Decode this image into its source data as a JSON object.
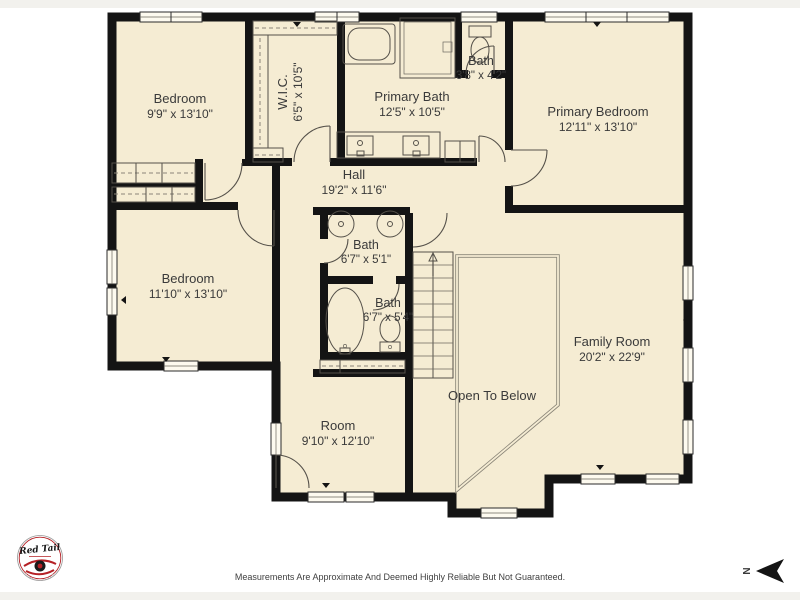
{
  "page": {
    "background": "#ffffff",
    "strip_color": "#f2f1ed"
  },
  "plan": {
    "floor_color": "#f5ecd3",
    "wall_color": "#141414",
    "fixture_line_color": "#55514a",
    "railing_color": "#8a8578",
    "text_color": "#3a3a3a"
  },
  "rooms": [
    {
      "id": "bedroom-top-left",
      "name": "Bedroom",
      "dims": "9'9\" x 13'10\""
    },
    {
      "id": "walk-in-closet",
      "name": "W.I.C.",
      "dims": "6'5\" x 10'5\""
    },
    {
      "id": "primary-bath",
      "name": "Primary Bath",
      "dims": "12'5\" x 10'5\""
    },
    {
      "id": "bath-small",
      "name": "Bath",
      "dims": "3'8\" x 4'2\""
    },
    {
      "id": "primary-bedroom",
      "name": "Primary Bedroom",
      "dims": "12'11\" x 13'10\""
    },
    {
      "id": "hall",
      "name": "Hall",
      "dims": "19'2\" x 11'6\""
    },
    {
      "id": "bedroom-left",
      "name": "Bedroom",
      "dims": "11'10\" x 13'10\""
    },
    {
      "id": "bath-upper",
      "name": "Bath",
      "dims": "6'7\" x 5'1\""
    },
    {
      "id": "bath-lower",
      "name": "Bath",
      "dims": "6'7\" x 5'4\""
    },
    {
      "id": "family-room",
      "name": "Family Room",
      "dims": "20'2\" x 22'9\""
    },
    {
      "id": "open-to-below",
      "name": "Open To Below",
      "dims": ""
    },
    {
      "id": "room",
      "name": "Room",
      "dims": "9'10\" x 12'10\""
    }
  ],
  "footer": {
    "disclaimer": "Measurements Are Approximate And Deemed Highly Reliable But Not Guaranteed."
  },
  "logo": {
    "brand": "Red Tail"
  },
  "compass": {
    "label": "N"
  }
}
